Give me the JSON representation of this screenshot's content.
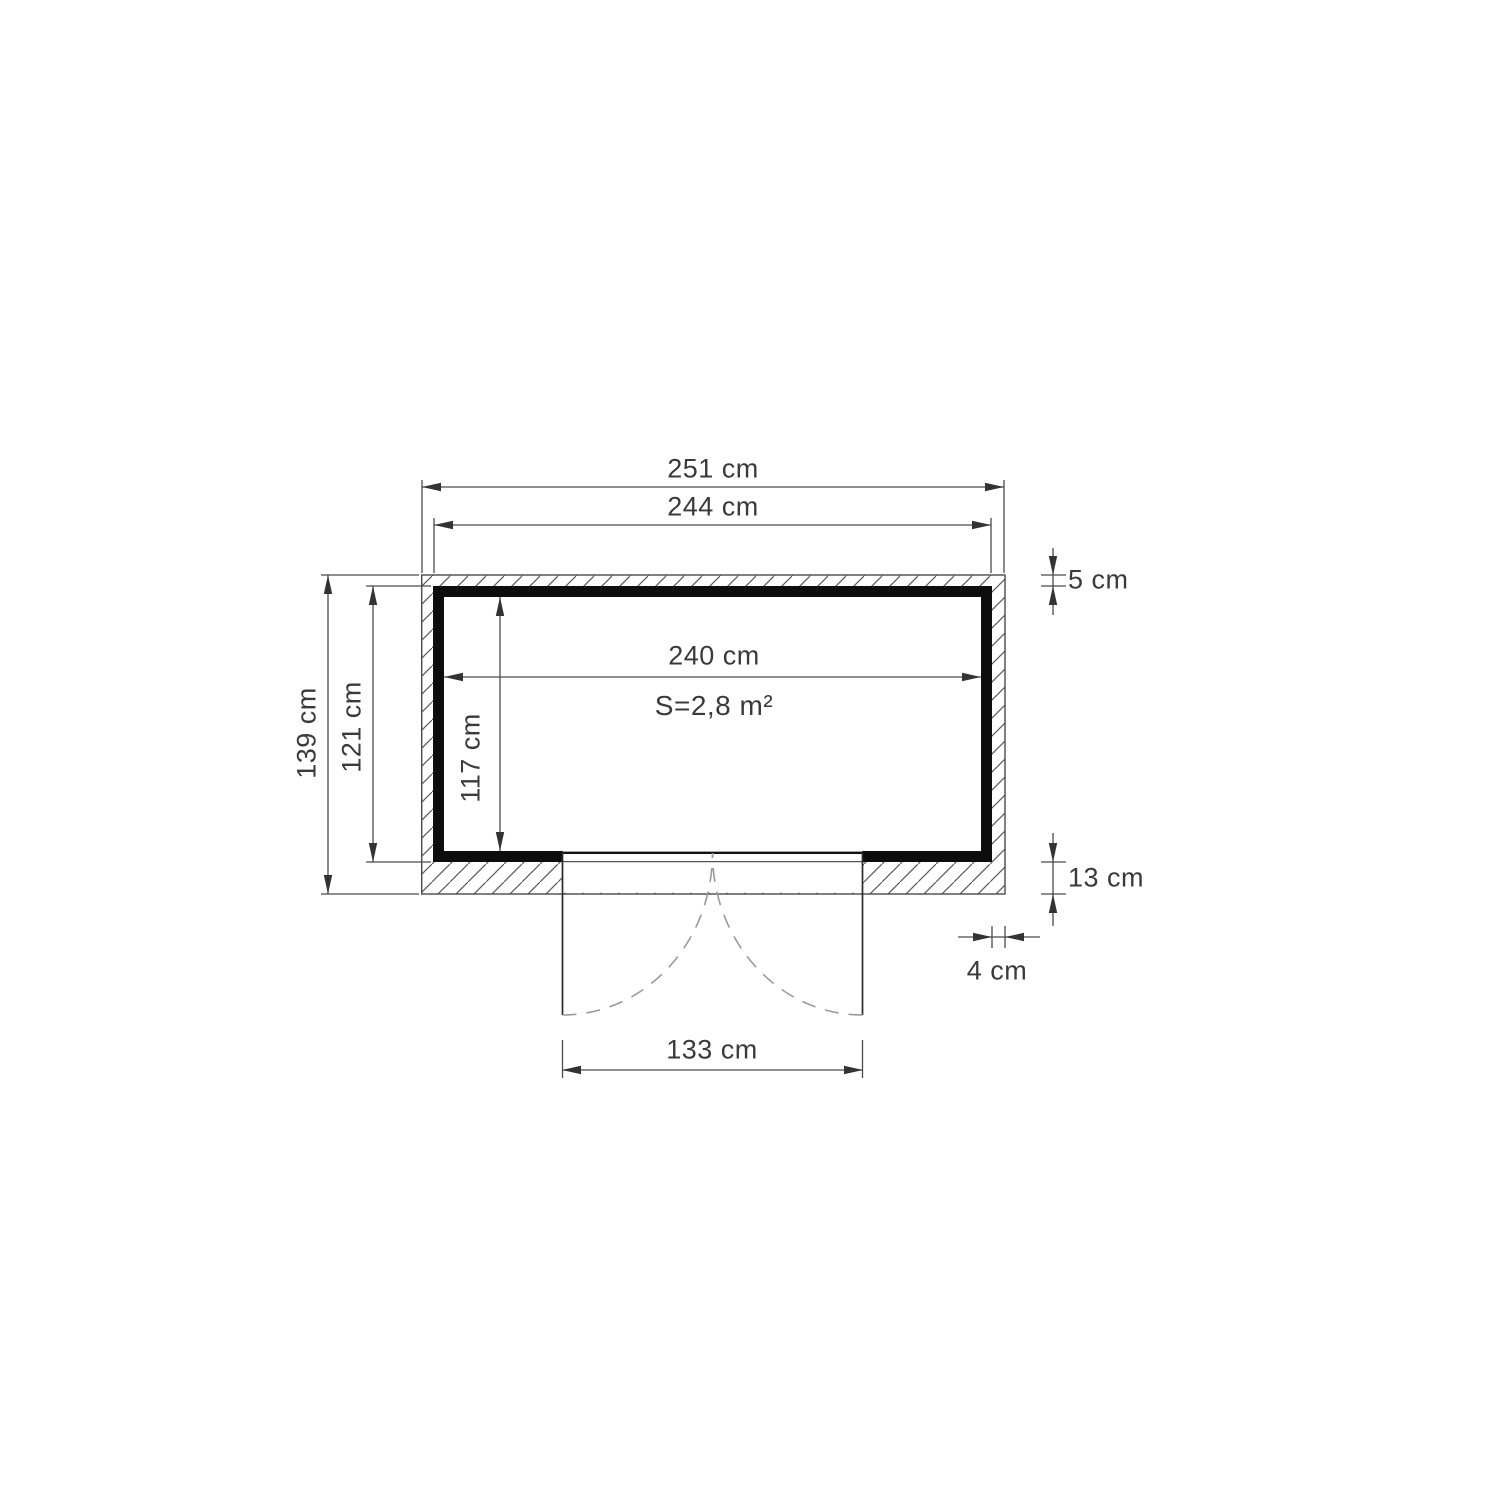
{
  "labels": {
    "overall_width": "251 cm",
    "frame_width": "244 cm",
    "interior_width": "240 cm",
    "area": "S=2,8 m²",
    "interior_depth": "117 cm",
    "frame_depth": "121 cm",
    "overall_depth": "139 cm",
    "overhang_top": "5 cm",
    "overhang_bottom": "13 cm",
    "overhang_side": "4 cm",
    "door_width": "133 cm"
  },
  "colors": {
    "background": "#ffffff",
    "wall": "#0d0d0d",
    "line": "#4a4a4a",
    "text": "#3a3a3a",
    "door_swing_dashed": "#9a9a9a"
  }
}
